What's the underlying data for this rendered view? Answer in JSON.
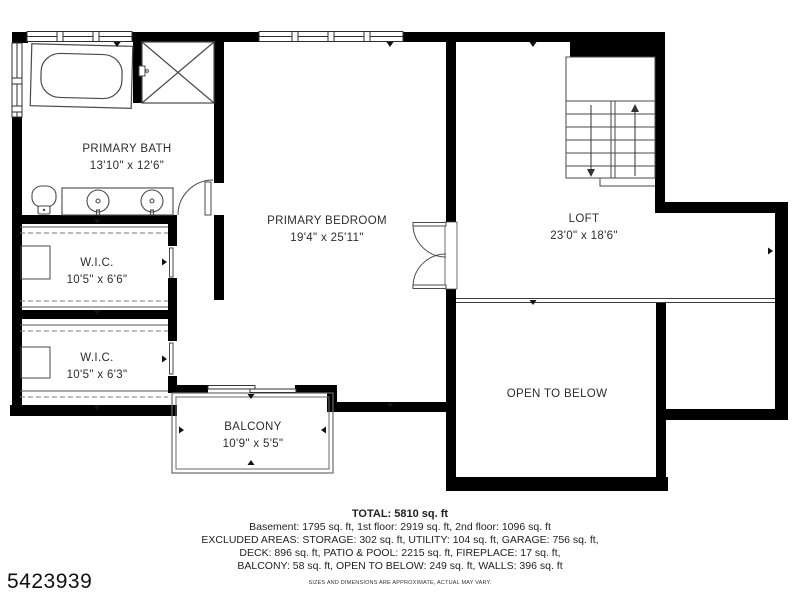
{
  "rooms": {
    "primary_bath": {
      "name": "PRIMARY BATH",
      "dims": "13'10\" x 12'6\""
    },
    "primary_bedroom": {
      "name": "PRIMARY BEDROOM",
      "dims": "19'4\" x 25'11\""
    },
    "wic_upper": {
      "name": "W.I.C.",
      "dims": "10'5\" x 6'6\""
    },
    "wic_lower": {
      "name": "W.I.C.",
      "dims": "10'5\" x 6'3\""
    },
    "loft": {
      "name": "LOFT",
      "dims": "23'0\" x 18'6\""
    },
    "open_to_below": {
      "name": "OPEN TO BELOW"
    },
    "balcony": {
      "name": "BALCONY",
      "dims": "10'9\" x 5'5\""
    }
  },
  "summary": {
    "total": "TOTAL: 5810 sq. ft",
    "line1": "Basement: 1795 sq. ft, 1st floor: 2919 sq. ft, 2nd floor: 1096 sq. ft",
    "line2": "EXCLUDED AREAS: STORAGE: 302 sq. ft, UTILITY: 104 sq. ft, GARAGE: 756 sq. ft,",
    "line3": "DECK: 896 sq. ft, PATIO & POOL: 2215 sq. ft, FIREPLACE: 17 sq. ft,",
    "line4": "BALCONY: 58 sq. ft, OPEN TO BELOW: 249 sq. ft, WALLS: 396 sq. ft",
    "disclaimer": "SIZES AND DIMENSIONS ARE APPROXIMATE, ACTUAL MAY VARY."
  },
  "listing_id": "5423939",
  "fixtures": [
    "bathtub",
    "shower",
    "toilet",
    "double-vanity",
    "staircase",
    "french-doors",
    "sliding-door",
    "closet-rods",
    "loft-railing",
    "balcony-railing"
  ],
  "colors": {
    "wall": "#000000",
    "fixture_line": "#4a4a4a",
    "text": "#2d2d2d",
    "background": "#ffffff"
  }
}
